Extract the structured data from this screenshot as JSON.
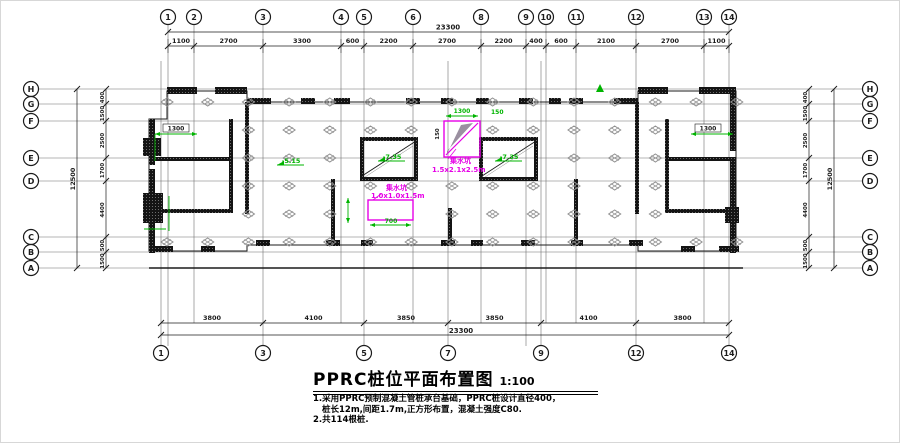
{
  "drawing": {
    "title": "PPRC桩位平面布置图",
    "scale": "1:100",
    "notes": [
      "1.采用PPRC预制混凝土管桩承台基础，PPRC桩设计直径400，",
      "桩长12m,间距1.7m,正方形布置，混凝土强度C80.",
      "2.共114根桩."
    ]
  },
  "axes": {
    "top": [
      {
        "label": "1",
        "x": 167
      },
      {
        "label": "2",
        "x": 193
      },
      {
        "label": "3",
        "x": 262
      },
      {
        "label": "4",
        "x": 340
      },
      {
        "label": "5",
        "x": 363
      },
      {
        "label": "6",
        "x": 412
      },
      {
        "label": "8",
        "x": 480
      },
      {
        "label": "9",
        "x": 525
      },
      {
        "label": "10",
        "x": 545
      },
      {
        "label": "11",
        "x": 575
      },
      {
        "label": "12",
        "x": 635
      },
      {
        "label": "13",
        "x": 703
      },
      {
        "label": "14",
        "x": 728
      }
    ],
    "bottom": [
      {
        "label": "1",
        "x": 160
      },
      {
        "label": "3",
        "x": 262
      },
      {
        "label": "5",
        "x": 363
      },
      {
        "label": "7",
        "x": 447
      },
      {
        "label": "9",
        "x": 540
      },
      {
        "label": "12",
        "x": 635
      },
      {
        "label": "14",
        "x": 728
      }
    ],
    "left": [
      {
        "label": "H",
        "y": 88
      },
      {
        "label": "G",
        "y": 103
      },
      {
        "label": "F",
        "y": 120
      },
      {
        "label": "E",
        "y": 157
      },
      {
        "label": "D",
        "y": 180
      },
      {
        "label": "C",
        "y": 236
      },
      {
        "label": "B",
        "y": 251
      },
      {
        "label": "A",
        "y": 267
      }
    ],
    "right": [
      {
        "label": "H",
        "y": 88
      },
      {
        "label": "G",
        "y": 103
      },
      {
        "label": "F",
        "y": 120
      },
      {
        "label": "E",
        "y": 157
      },
      {
        "label": "D",
        "y": 180
      },
      {
        "label": "C",
        "y": 236
      },
      {
        "label": "B",
        "y": 251
      },
      {
        "label": "A",
        "y": 267
      }
    ]
  },
  "dimensions": {
    "top": {
      "total": "23300",
      "segments": [
        "1100",
        "2700",
        "3300",
        "600",
        "2200",
        "2700",
        "2200",
        "400",
        "600",
        "2100",
        "2700",
        "1100"
      ]
    },
    "bottom": {
      "total": "23300",
      "segments": [
        "3800",
        "4100",
        "3850",
        "3850",
        "4100",
        "3800"
      ]
    },
    "left": {
      "total": "12500",
      "segments": [
        "400",
        "1500",
        "2500",
        "1700",
        "4400",
        "500",
        "1500"
      ]
    },
    "right": {
      "total": "12500",
      "segments": [
        "400",
        "1500",
        "2500",
        "1700",
        "4400",
        "500",
        "1500"
      ]
    }
  },
  "annotations": {
    "pits": [
      {
        "label": "集水坑",
        "size": "1.5x2.1x2.5m"
      },
      {
        "label": "集水坑",
        "size": "1.0x1.0x1.5m"
      }
    ],
    "pit_dimensions": [
      "1300",
      "150",
      "700",
      "150"
    ],
    "core_dimensions": [
      "1300",
      "1300"
    ],
    "elevations": [
      "-7.35",
      "-7.35",
      "-5.15"
    ]
  },
  "colors": {
    "line": "#1b1b1b",
    "grid": "#6f6f6f",
    "pile": "#8f8f8f",
    "magenta": "#e600e6",
    "green": "#00b400",
    "background": "#ffffff"
  }
}
